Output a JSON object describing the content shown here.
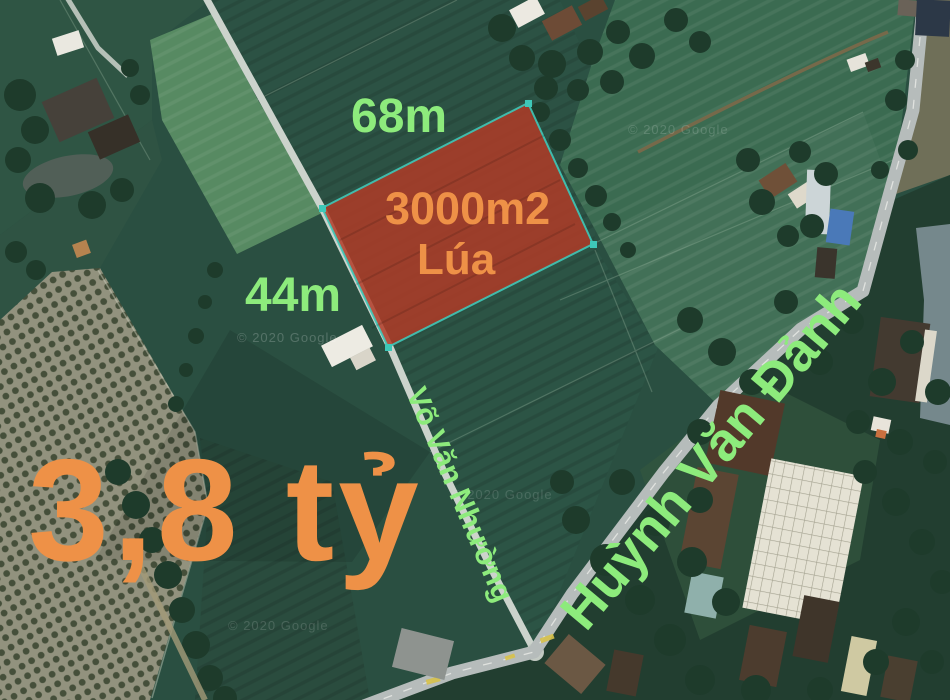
{
  "map_overlay": {
    "plot": {
      "top_edge_length": "68m",
      "left_edge_length": "44m",
      "area_label": "3000m2",
      "crop_label": "Lúa",
      "price": "3,8 tỷ"
    },
    "roads": [
      {
        "name": "Võ Văn Nhường"
      },
      {
        "name": "Huỳnh Văn Đảnh"
      }
    ],
    "watermark": "© 2020 Google",
    "colors": {
      "label_green": "#8deb7c",
      "label_orange": "#ee9147",
      "plot_fill": "#b23a26",
      "plot_stroke": "#3ec8b8"
    }
  }
}
